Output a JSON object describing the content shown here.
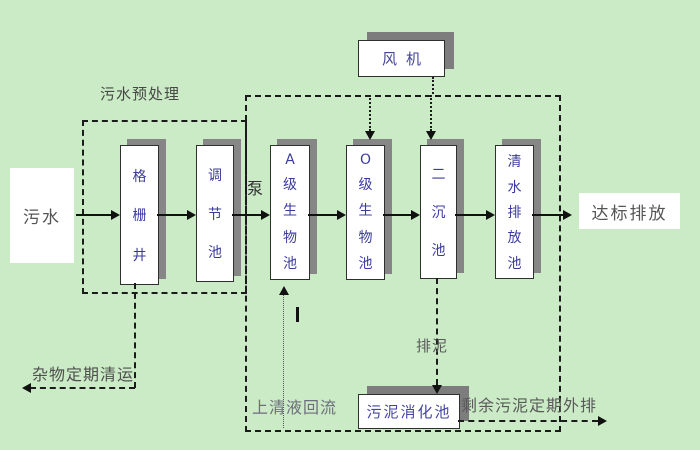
{
  "diagram": {
    "type": "wastewater-treatment-process-flow",
    "colors": {
      "background": "#caebc5",
      "box_fill": "#ffffff",
      "box_border": "#2f2f2f",
      "box_shadow": "#868686",
      "tank_text": "#3b3b9e",
      "annotation_text": "#4f4f4f",
      "line": "#111111"
    },
    "endpoints": {
      "influent": "污水",
      "discharge": "达标排放"
    },
    "tanks": {
      "grid_well": "格栅井",
      "regulating": "调节池",
      "a_bio": "A级生物池",
      "o_bio": "O级生物池",
      "secondary_sed": "二沉池",
      "clear_water": "清水排放池",
      "fan": "风机",
      "sludge_digestion": "污泥消化池"
    },
    "labels": {
      "pretreatment": "污水预处理",
      "pump": "泵",
      "debris_removal": "杂物定期清运",
      "supernatant_return": "上清液回流",
      "sludge_discharge": "排泥",
      "excess_sludge": "剩余污泥定期外排"
    }
  }
}
